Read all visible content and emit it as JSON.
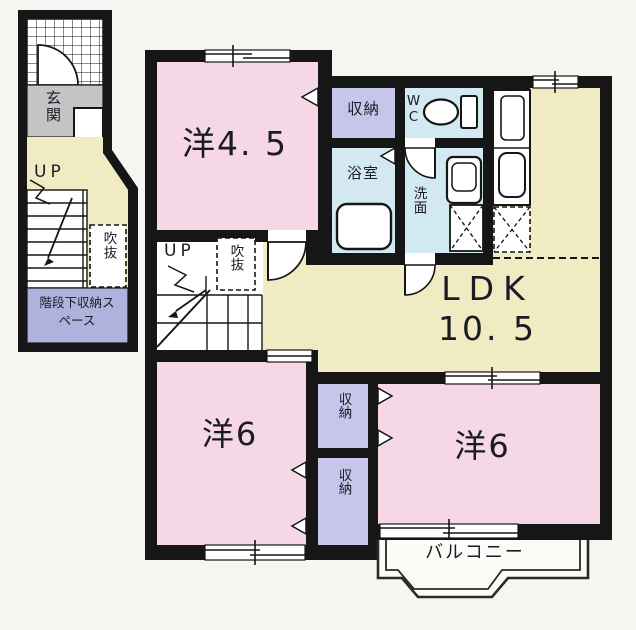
{
  "colors": {
    "background": "#f6f5f2",
    "wall": "#161616",
    "room_pink": "#f5d7e6",
    "ldk_yellow": "#f0ebc2",
    "closet_purple": "#c6c6ea",
    "wet_area_blue": "#d3e9f2",
    "genkan_gray": "#c4c4c4",
    "storage_lavender": "#aeb2dc",
    "floor_white": "#ffffff"
  },
  "first_floor": {
    "genkan_label": "玄関",
    "up_label": "UP",
    "void_label": "吹抜",
    "understair_label": "階段下収納スペース"
  },
  "second_floor": {
    "western_room_45_label": "洋4. 5",
    "closet_top_label": "収納",
    "wc_label": "WC",
    "bath_label": "浴室",
    "washroom_label": "洗面",
    "up_label": "UP",
    "void_label": "吹抜",
    "ldk_label": "LDK",
    "ldk_area_label": "10. 5",
    "western_room_6_left_label": "洋6",
    "closet_upper_label": "収納",
    "closet_lower_label": "収納",
    "western_room_6_right_label": "洋6",
    "balcony_label": "バルコニー"
  }
}
